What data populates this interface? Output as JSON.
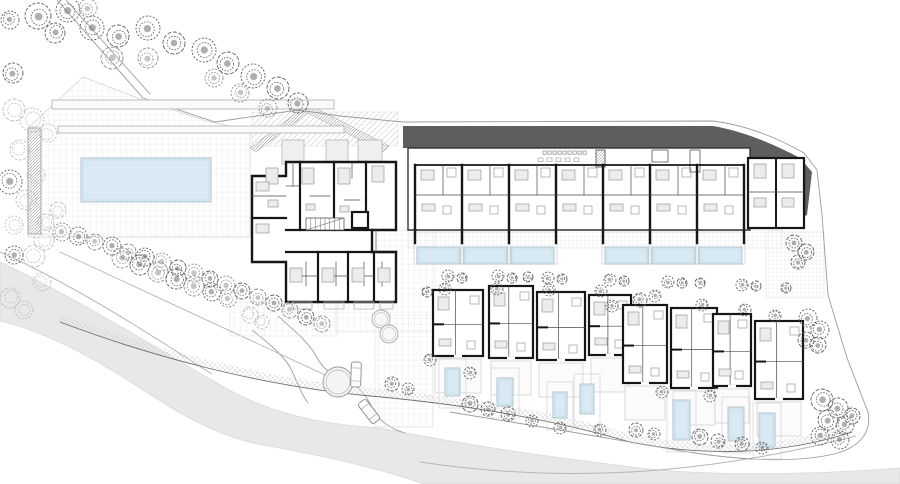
{
  "canvas": {
    "w": 900,
    "h": 484,
    "bg": "#ffffff"
  },
  "palette": {
    "road": "#e8e8e8",
    "roof_dark": "#5e5e5e",
    "pool_fill": "#d9eaf4",
    "pool_border": "#a8bfcc",
    "pool_inner": "#c2d6e2",
    "wall": "#161616",
    "thin_wall": "#4a4a4a",
    "light_line": "#b5b5b5",
    "furniture_fill": "#ececec",
    "furniture_stroke": "#9a9a9a",
    "grid_line": "#e2e2e2",
    "boundary": "#9b9b9b",
    "tree_tones": [
      "#5f5f5f",
      "#8c8c8c",
      "#bdbdbd"
    ]
  },
  "road": {
    "surface": "M0,262 C80,300 160,350 215,382 C270,415 320,424 380,428 C480,448 560,458 640,468 C720,477 820,474 900,468 L900,484 L424,484 C360,462 300,452 253,443 C200,430 160,400 143,390 C90,355 40,330 0,321 Z",
    "curbs": [
      "M0,252 C80,288 152,336 212,374",
      "M420,462 C560,483 700,476 856,436"
    ],
    "street_edges": [
      "M278,316 C296,332 310,344 316,356 C323,369 331,375 346,381 C361,387 367,397 373,409 C379,421 391,429 405,433",
      "M252,330 C272,346 284,356 291,369 C297,381 300,392 308,403"
    ],
    "survey_line": "M60,252 L336,380"
  },
  "boundaries": [
    "M57,0 L143,98 L215,122 L298,110 L340,116 L403,122",
    "M66,0 L150,94",
    "M403,122 L713,121 C745,125 776,137 804,153 L817,170 L822,215",
    "M822,215 L828,295 L847,358 L868,412 C872,432 860,446 838,453 C796,464 740,460 688,452 L560,430 L450,412"
  ],
  "promenade": {
    "band": "M60,318 C150,352 260,382 370,392 C450,399 540,412 630,438 C700,452 780,452 852,428",
    "edge": "M60,322 C150,356 260,386 370,396 C450,403 540,416 630,442 C700,456 780,456 852,432"
  },
  "hardscape": {
    "pool_deck": "M83,77 L143,100 L210,122 L250,130 L250,237 L28,237 L28,128 Z",
    "plazas": [
      {
        "x": 252,
        "y": 112,
        "w": 146,
        "h": 34,
        "pat": "diag"
      },
      {
        "x": 335,
        "y": 230,
        "w": 100,
        "h": 102,
        "pat": "grid6"
      },
      {
        "x": 230,
        "y": 302,
        "w": 108,
        "h": 34,
        "pat": "grid6"
      },
      {
        "x": 408,
        "y": 230,
        "w": 374,
        "h": 18,
        "pat": "grid4"
      },
      {
        "x": 766,
        "y": 232,
        "w": 58,
        "h": 66,
        "pat": "grid4"
      },
      {
        "x": 598,
        "y": 302,
        "w": 30,
        "h": 58,
        "pat": "grid4"
      },
      {
        "x": 375,
        "y": 315,
        "w": 58,
        "h": 112,
        "pat": "grid6"
      }
    ],
    "ramp_band": "M250,148 L305,106 L312,106 L389,146 L383,152 L308,113 L256,152 Z"
  },
  "pools": {
    "main": {
      "x": 81,
      "y": 158,
      "w": 130,
      "h": 44
    },
    "terrace_row": [
      {
        "x": 417,
        "y": 247,
        "w": 43,
        "h": 17
      },
      {
        "x": 464,
        "y": 247,
        "w": 43,
        "h": 17
      },
      {
        "x": 511,
        "y": 247,
        "w": 43,
        "h": 17
      },
      {
        "x": 605,
        "y": 247,
        "w": 43,
        "h": 17
      },
      {
        "x": 652,
        "y": 247,
        "w": 43,
        "h": 17
      },
      {
        "x": 699,
        "y": 247,
        "w": 43,
        "h": 17
      }
    ],
    "villa_pools": [
      {
        "x": 445,
        "y": 368,
        "w": 15,
        "h": 28
      },
      {
        "x": 497,
        "y": 378,
        "w": 16,
        "h": 28
      },
      {
        "x": 553,
        "y": 392,
        "w": 14,
        "h": 26
      },
      {
        "x": 580,
        "y": 384,
        "w": 14,
        "h": 30
      },
      {
        "x": 673,
        "y": 400,
        "w": 17,
        "h": 40
      },
      {
        "x": 728,
        "y": 407,
        "w": 16,
        "h": 34
      },
      {
        "x": 759,
        "y": 413,
        "w": 16,
        "h": 34
      }
    ]
  },
  "roof_canopy": "M403,126 L713,126 C742,131 772,143 800,158 L812,172 L807,215 L795,221 L772,205 L748,188 L724,166 L708,148 L403,148 Z",
  "building_b": {
    "body": {
      "x": 408,
      "y": 148,
      "w": 342,
      "h": 82
    },
    "modules": [
      415,
      462,
      509,
      556,
      603,
      650,
      697
    ],
    "module_w": 47,
    "right_wing": {
      "x": 748,
      "y": 158,
      "w": 56,
      "h": 70
    },
    "amenity": {
      "tables": {
        "x0": 543,
        "y": 151,
        "n": 9,
        "step": 5,
        "s": 3.2
      },
      "chairs": {
        "x0": 538,
        "y": 158,
        "n": 5,
        "step": 9,
        "w": 5,
        "h": 3.5
      },
      "kitchen": {
        "x": 596,
        "y": 150,
        "w": 9,
        "h": 17
      },
      "island": {
        "x": 652,
        "y": 150,
        "w": 16,
        "h": 12
      },
      "counter": {
        "x": 690,
        "y": 150,
        "w": 10,
        "h": 22
      }
    }
  },
  "building_a": {
    "outline": "M252,176 L286,176 L286,162 L396,162 L396,230 L372,230 L372,252 L396,252 L396,302 L286,302 L286,262 L252,262 Z",
    "thick_lines": [
      [
        300,
        162,
        300,
        230
      ],
      [
        334,
        162,
        334,
        230
      ],
      [
        366,
        162,
        366,
        230
      ],
      [
        286,
        230,
        372,
        230
      ],
      [
        286,
        252,
        396,
        252
      ],
      [
        318,
        252,
        318,
        302
      ],
      [
        348,
        252,
        348,
        302
      ],
      [
        374,
        252,
        374,
        302
      ],
      [
        252,
        218,
        286,
        218
      ]
    ],
    "thin_lines": [
      [
        293,
        162,
        293,
        186
      ],
      [
        310,
        196,
        330,
        196
      ],
      [
        344,
        200,
        360,
        200
      ],
      [
        286,
        186,
        300,
        186
      ],
      [
        252,
        196,
        286,
        196
      ],
      [
        306,
        262,
        306,
        286
      ],
      [
        336,
        262,
        336,
        286
      ],
      [
        364,
        262,
        364,
        286
      ],
      [
        382,
        262,
        382,
        286
      ],
      [
        300,
        276,
        318,
        276
      ],
      [
        330,
        276,
        348,
        276
      ],
      [
        356,
        276,
        374,
        276
      ],
      [
        376,
        230,
        376,
        252
      ],
      [
        352,
        162,
        352,
        178
      ]
    ],
    "stairs": {
      "x": 306,
      "y": 218,
      "w": 38,
      "h": 12,
      "steps": 8
    },
    "elevator": {
      "x": 352,
      "y": 212,
      "w": 16,
      "h": 16
    },
    "furniture": [
      [
        266,
        168,
        12,
        16
      ],
      [
        302,
        168,
        12,
        16
      ],
      [
        338,
        168,
        12,
        16
      ],
      [
        372,
        166,
        12,
        16
      ],
      [
        256,
        182,
        13,
        9
      ],
      [
        256,
        224,
        13,
        9
      ],
      [
        290,
        268,
        12,
        14
      ],
      [
        322,
        268,
        12,
        14
      ],
      [
        352,
        268,
        12,
        14
      ],
      [
        378,
        268,
        12,
        14
      ],
      [
        268,
        200,
        10,
        7
      ],
      [
        306,
        204,
        9,
        6
      ],
      [
        340,
        206,
        9,
        6
      ]
    ],
    "balconies_top": [
      [
        282,
        140,
        22,
        24
      ],
      [
        326,
        140,
        22,
        24
      ],
      [
        358,
        140,
        24,
        24
      ]
    ],
    "balconies_bottom": [
      [
        292,
        302,
        20,
        7
      ],
      [
        324,
        302,
        20,
        7
      ],
      [
        354,
        302,
        20,
        7
      ],
      [
        380,
        302,
        13,
        7
      ]
    ]
  },
  "villas": [
    {
      "x": 433,
      "y": 290,
      "w": 50,
      "h": 66
    },
    {
      "x": 489,
      "y": 286,
      "w": 44,
      "h": 72
    },
    {
      "x": 537,
      "y": 292,
      "w": 48,
      "h": 68
    },
    {
      "x": 589,
      "y": 295,
      "w": 42,
      "h": 60
    },
    {
      "x": 623,
      "y": 305,
      "w": 44,
      "h": 78
    },
    {
      "x": 671,
      "y": 308,
      "w": 46,
      "h": 80
    },
    {
      "x": 713,
      "y": 314,
      "w": 38,
      "h": 72
    },
    {
      "x": 755,
      "y": 321,
      "w": 48,
      "h": 78
    }
  ],
  "features": {
    "planter_bars": [
      [
        52,
        100,
        282,
        9
      ],
      [
        58,
        126,
        286,
        7
      ]
    ],
    "wall_hatch": [
      28,
      128,
      13,
      106
    ],
    "hot_tubs": [
      [
        381,
        319,
        9
      ],
      [
        389,
        334,
        9
      ]
    ],
    "roundabout": {
      "cx": 338,
      "cy": 382,
      "r": 15
    },
    "cars": [
      {
        "x": 351,
        "y": 362,
        "w": 10,
        "h": 25,
        "rot": 2
      },
      {
        "x": 364,
        "y": 399,
        "w": 10,
        "h": 25,
        "rot": -38
      }
    ]
  },
  "trees": [
    [
      38,
      16,
      13,
      0
    ],
    [
      68,
      10,
      12,
      0
    ],
    [
      55,
      33,
      10,
      0
    ],
    [
      92,
      28,
      12,
      0
    ],
    [
      118,
      36,
      11,
      0
    ],
    [
      148,
      28,
      12,
      0
    ],
    [
      174,
      43,
      11,
      0
    ],
    [
      204,
      50,
      12,
      0
    ],
    [
      148,
      58,
      10,
      1
    ],
    [
      112,
      58,
      11,
      1
    ],
    [
      228,
      63,
      11,
      0
    ],
    [
      253,
      76,
      12,
      0
    ],
    [
      278,
      88,
      11,
      0
    ],
    [
      298,
      103,
      10,
      0
    ],
    [
      268,
      108,
      9,
      1
    ],
    [
      240,
      93,
      9,
      1
    ],
    [
      214,
      78,
      9,
      1
    ],
    [
      13,
      73,
      10,
      0
    ],
    [
      10,
      20,
      9,
      0
    ],
    [
      88,
      8,
      9,
      1
    ],
    [
      14,
      110,
      11,
      2
    ],
    [
      32,
      120,
      12,
      2
    ],
    [
      48,
      133,
      9,
      2
    ],
    [
      20,
      150,
      10,
      2
    ],
    [
      10,
      182,
      12,
      0
    ],
    [
      36,
      175,
      9,
      2
    ],
    [
      26,
      200,
      10,
      2
    ],
    [
      14,
      225,
      9,
      2
    ],
    [
      58,
      210,
      8,
      2
    ],
    [
      46,
      222,
      8,
      2
    ],
    [
      62,
      232,
      9,
      1
    ],
    [
      78,
      236,
      9,
      0
    ],
    [
      95,
      242,
      8,
      1
    ],
    [
      112,
      246,
      9,
      0
    ],
    [
      128,
      252,
      8,
      1
    ],
    [
      145,
      257,
      9,
      0
    ],
    [
      162,
      262,
      9,
      1
    ],
    [
      178,
      268,
      8,
      0
    ],
    [
      194,
      273,
      9,
      1
    ],
    [
      210,
      279,
      8,
      0
    ],
    [
      226,
      285,
      9,
      1
    ],
    [
      242,
      291,
      8,
      0
    ],
    [
      258,
      297,
      8,
      1
    ],
    [
      274,
      303,
      8,
      0
    ],
    [
      290,
      310,
      8,
      1
    ],
    [
      306,
      317,
      8,
      0
    ],
    [
      322,
      324,
      8,
      1
    ],
    [
      44,
      240,
      10,
      2
    ],
    [
      34,
      256,
      11,
      2
    ],
    [
      14,
      255,
      9,
      0
    ],
    [
      10,
      298,
      10,
      2
    ],
    [
      42,
      282,
      9,
      2
    ],
    [
      24,
      310,
      9,
      2
    ],
    [
      122,
      258,
      10,
      1
    ],
    [
      140,
      265,
      10,
      0
    ],
    [
      158,
      272,
      10,
      1
    ],
    [
      176,
      279,
      10,
      0
    ],
    [
      194,
      286,
      10,
      1
    ],
    [
      212,
      292,
      9,
      0
    ],
    [
      228,
      298,
      9,
      1
    ],
    [
      250,
      315,
      8,
      2
    ],
    [
      262,
      322,
      7,
      2
    ],
    [
      448,
      276,
      6,
      0
    ],
    [
      462,
      278,
      5,
      0
    ],
    [
      498,
      276,
      6,
      0
    ],
    [
      512,
      278,
      5,
      0
    ],
    [
      528,
      277,
      5,
      0
    ],
    [
      548,
      278,
      6,
      0
    ],
    [
      562,
      279,
      5,
      0
    ],
    [
      610,
      280,
      6,
      0
    ],
    [
      624,
      281,
      5,
      0
    ],
    [
      668,
      282,
      6,
      0
    ],
    [
      682,
      283,
      5,
      0
    ],
    [
      700,
      283,
      5,
      0
    ],
    [
      742,
      285,
      6,
      0
    ],
    [
      756,
      286,
      5,
      0
    ],
    [
      786,
      288,
      5,
      0
    ],
    [
      794,
      243,
      8,
      0
    ],
    [
      806,
      252,
      8,
      0
    ],
    [
      798,
      262,
      7,
      0
    ],
    [
      445,
      289,
      6,
      0
    ],
    [
      497,
      289,
      6,
      0
    ],
    [
      549,
      290,
      6,
      0
    ],
    [
      601,
      291,
      6,
      0
    ],
    [
      427,
      292,
      5,
      0
    ],
    [
      808,
      318,
      9,
      0
    ],
    [
      820,
      330,
      9,
      0
    ],
    [
      806,
      340,
      8,
      0
    ],
    [
      818,
      345,
      8,
      0
    ],
    [
      640,
      300,
      7,
      0
    ],
    [
      655,
      296,
      6,
      0
    ],
    [
      612,
      306,
      6,
      0
    ],
    [
      702,
      305,
      6,
      0
    ],
    [
      745,
      310,
      6,
      0
    ],
    [
      775,
      316,
      6,
      0
    ],
    [
      392,
      384,
      7,
      0
    ],
    [
      408,
      389,
      6,
      0
    ],
    [
      470,
      404,
      8,
      0
    ],
    [
      488,
      409,
      7,
      0
    ],
    [
      508,
      414,
      7,
      0
    ],
    [
      532,
      421,
      6,
      0
    ],
    [
      560,
      428,
      6,
      0
    ],
    [
      600,
      430,
      6,
      0
    ],
    [
      636,
      430,
      7,
      0
    ],
    [
      654,
      434,
      6,
      0
    ],
    [
      470,
      373,
      6,
      0
    ],
    [
      700,
      437,
      8,
      0
    ],
    [
      718,
      441,
      7,
      0
    ],
    [
      742,
      444,
      7,
      0
    ],
    [
      762,
      448,
      6,
      0
    ],
    [
      822,
      400,
      11,
      0
    ],
    [
      838,
      408,
      10,
      0
    ],
    [
      828,
      420,
      10,
      0
    ],
    [
      845,
      425,
      9,
      0
    ],
    [
      820,
      436,
      9,
      0
    ],
    [
      840,
      440,
      9,
      0
    ],
    [
      852,
      416,
      8,
      0
    ],
    [
      430,
      360,
      6,
      0
    ],
    [
      662,
      392,
      6,
      0
    ],
    [
      710,
      396,
      6,
      0
    ]
  ]
}
